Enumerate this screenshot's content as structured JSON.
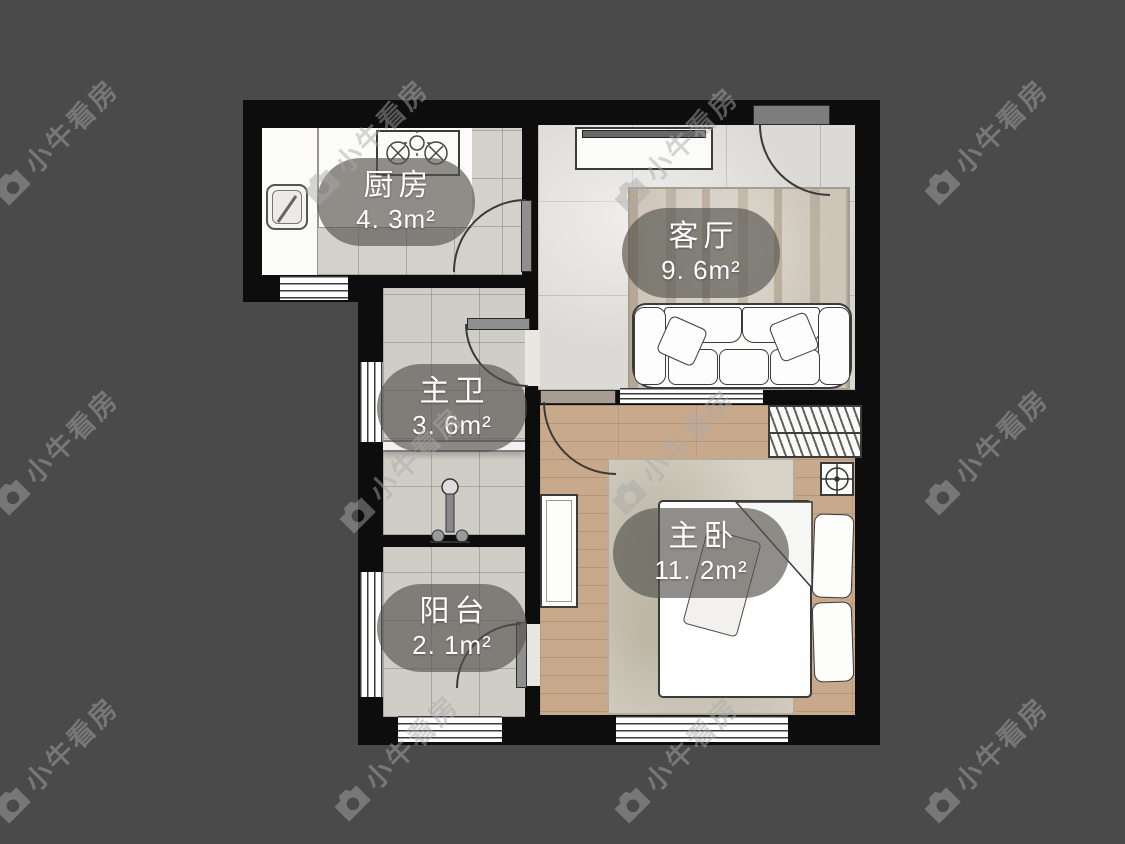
{
  "canvas": {
    "background_color": "#4a4a4a"
  },
  "floorplan": {
    "rooms": [
      {
        "id": "kitchen",
        "name": "厨房",
        "area": "4. 3m²"
      },
      {
        "id": "living-room",
        "name": "客厅",
        "area": "9. 6m²"
      },
      {
        "id": "bathroom",
        "name": "主卫",
        "area": "3. 6m²"
      },
      {
        "id": "bedroom",
        "name": "主卧",
        "area": "11. 2m²"
      },
      {
        "id": "balcony",
        "name": "阳台",
        "area": "2. 1m²"
      }
    ],
    "colors": {
      "wall": "#0d0d0d",
      "tile_floor": "#d4d1ca",
      "marble_floor": "#dcdad6",
      "wood_floor": "#c9a98c",
      "label_background": "rgba(85,83,78,0.66)",
      "label_text": "#ffffff"
    }
  },
  "watermark": {
    "text": "小牛看房",
    "icon": "camera-logo-icon"
  }
}
